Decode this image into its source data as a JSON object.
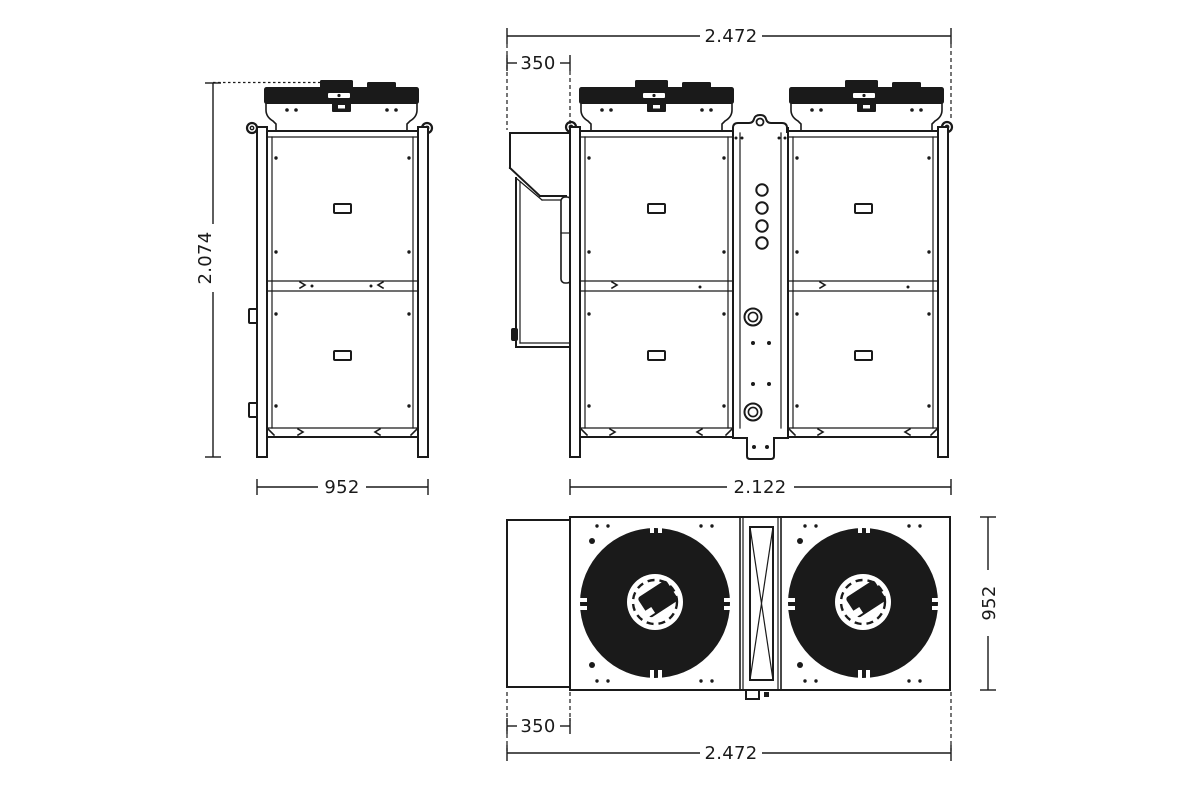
{
  "views": {
    "side": {
      "height_label": "2.074",
      "depth_label": "952"
    },
    "front": {
      "total_width_label": "2.472",
      "duct_width_label": "350",
      "frame_width_label": "2.122"
    },
    "top": {
      "depth_label": "952",
      "duct_width_label": "350",
      "total_width_label": "2.472"
    }
  },
  "colors": {
    "line": "#1a1a1a",
    "background": "#ffffff"
  }
}
